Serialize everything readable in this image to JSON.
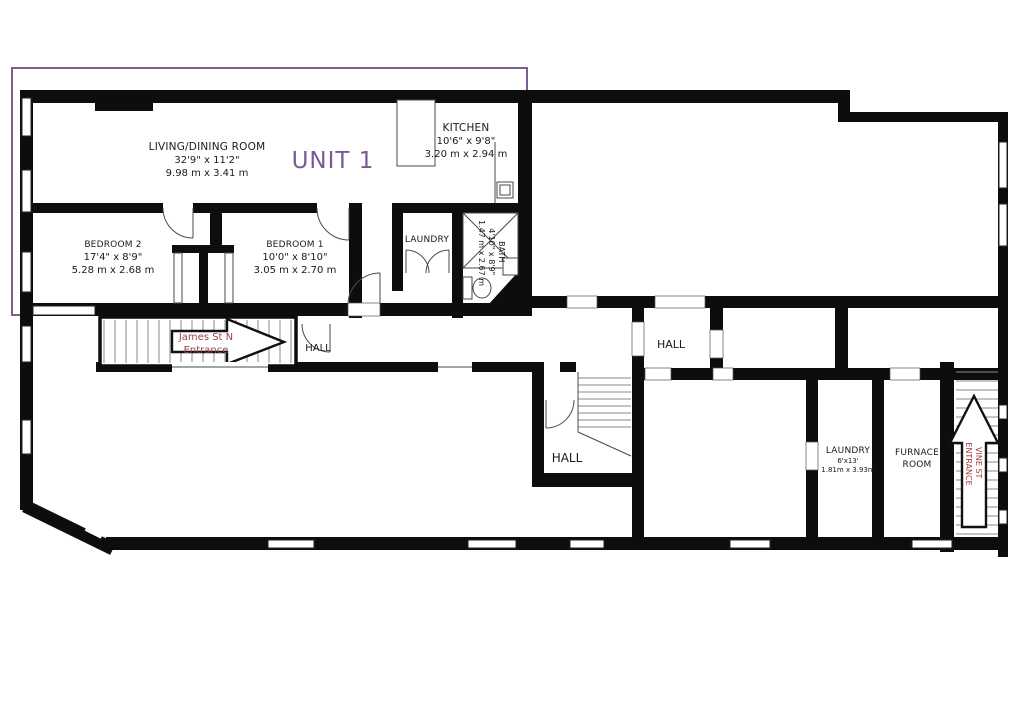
{
  "colors": {
    "background": "#ffffff",
    "walls": "#0d0d0d",
    "unit_outline": "#7d5c99",
    "unit_label_color": "#7b5a94",
    "entrance_label_color": "#9c4444",
    "room_label_color": "#1a1a1a"
  },
  "unit1": {
    "label": "UNIT 1",
    "rooms": {
      "living_dining": {
        "name": "LIVING/DINING ROOM",
        "imperial": "32'9\" x 11'2\"",
        "metric": "9.98 m x 3.41 m"
      },
      "kitchen": {
        "name": "KITCHEN",
        "imperial": "10'6\" x 9'8\"",
        "metric": "3.20 m x 2.94 m"
      },
      "bedroom2": {
        "name": "BEDROOM 2",
        "imperial": "17'4\" x 8'9\"",
        "metric": "5.28 m x 2.68 m"
      },
      "bedroom1": {
        "name": "BEDROOM 1",
        "imperial": "10'0\" x 8'10\"",
        "metric": "3.05 m x 2.70 m"
      },
      "laundry": {
        "name": "LAUNDRY"
      },
      "bath": {
        "name": "BATH",
        "imperial": "4'10\" x 8'9\"",
        "metric": "1.47 m x 2.67 m"
      }
    }
  },
  "building": {
    "halls": {
      "entry": "HALL",
      "center": "HALL",
      "mid": "HALL"
    },
    "laundry": {
      "name": "LAUNDRY",
      "imperial": "6'x13'",
      "metric": "1.81m x 3.93m"
    },
    "furnace_room": {
      "line1": "FURNACE",
      "line2": "ROOM"
    },
    "entrances": {
      "james_st": {
        "line1": "James St N",
        "line2": "Entrance"
      },
      "vine_st": {
        "line1": "VINE ST",
        "line2": "ENTRANCE"
      }
    }
  }
}
